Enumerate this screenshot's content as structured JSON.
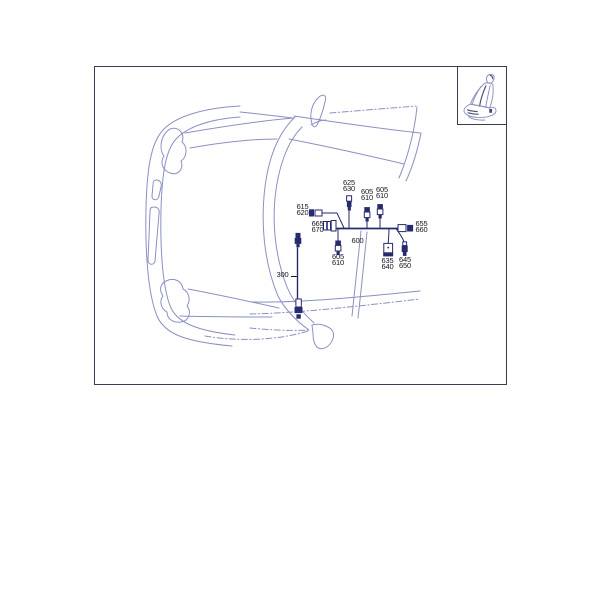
{
  "callouts": {
    "c625_630": {
      "l1": "625",
      "l2": "630"
    },
    "c605_610_a": {
      "l1": "605",
      "l2": "610"
    },
    "c605_610_b": {
      "l1": "605",
      "l2": "610"
    },
    "c615_620": {
      "l1": "615",
      "l2": "620"
    },
    "c665_670": {
      "l1": "665",
      "l2": "670"
    },
    "c600": {
      "l1": "600"
    },
    "c655_660": {
      "l1": "655",
      "l2": "660"
    },
    "c605_610_c": {
      "l1": "605",
      "l2": "610"
    },
    "c635_640": {
      "l1": "635",
      "l2": "640"
    },
    "c645_650": {
      "l1": "645",
      "l2": "650"
    },
    "c300": {
      "l1": "300"
    }
  },
  "icons": {
    "seat_inset": "car-seat-icon"
  },
  "colors": {
    "car_line": "#8a90c2",
    "harness": "#262a6e",
    "frame_border": "#3c3c50",
    "text": "#15151c",
    "seat_shade": "#4b4e6e"
  }
}
